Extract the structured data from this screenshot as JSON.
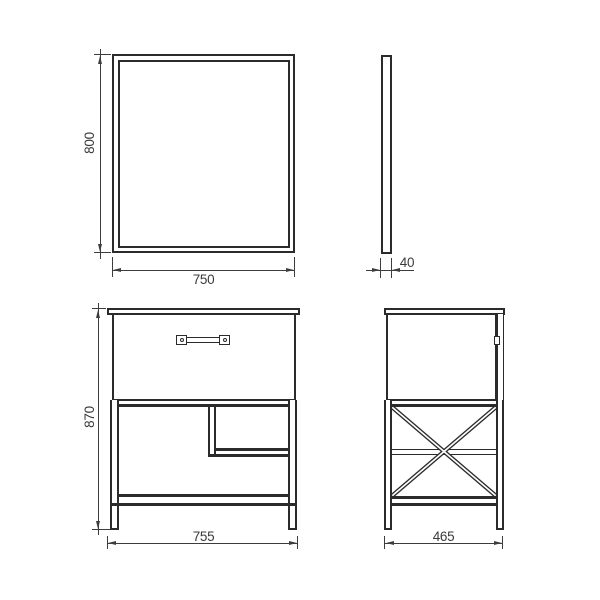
{
  "drawing": {
    "colors": {
      "line": "#2b2b2b",
      "dimension_line": "#3d3d3d",
      "text": "#3a3a3a",
      "background": "#ffffff"
    },
    "views": {
      "mirror_front": {
        "height_label": "800",
        "width_label": "750"
      },
      "mirror_side": {
        "depth_label": "40"
      },
      "cabinet_front": {
        "height_label": "870",
        "width_label": "755"
      },
      "cabinet_side": {
        "depth_label": "465"
      }
    }
  }
}
